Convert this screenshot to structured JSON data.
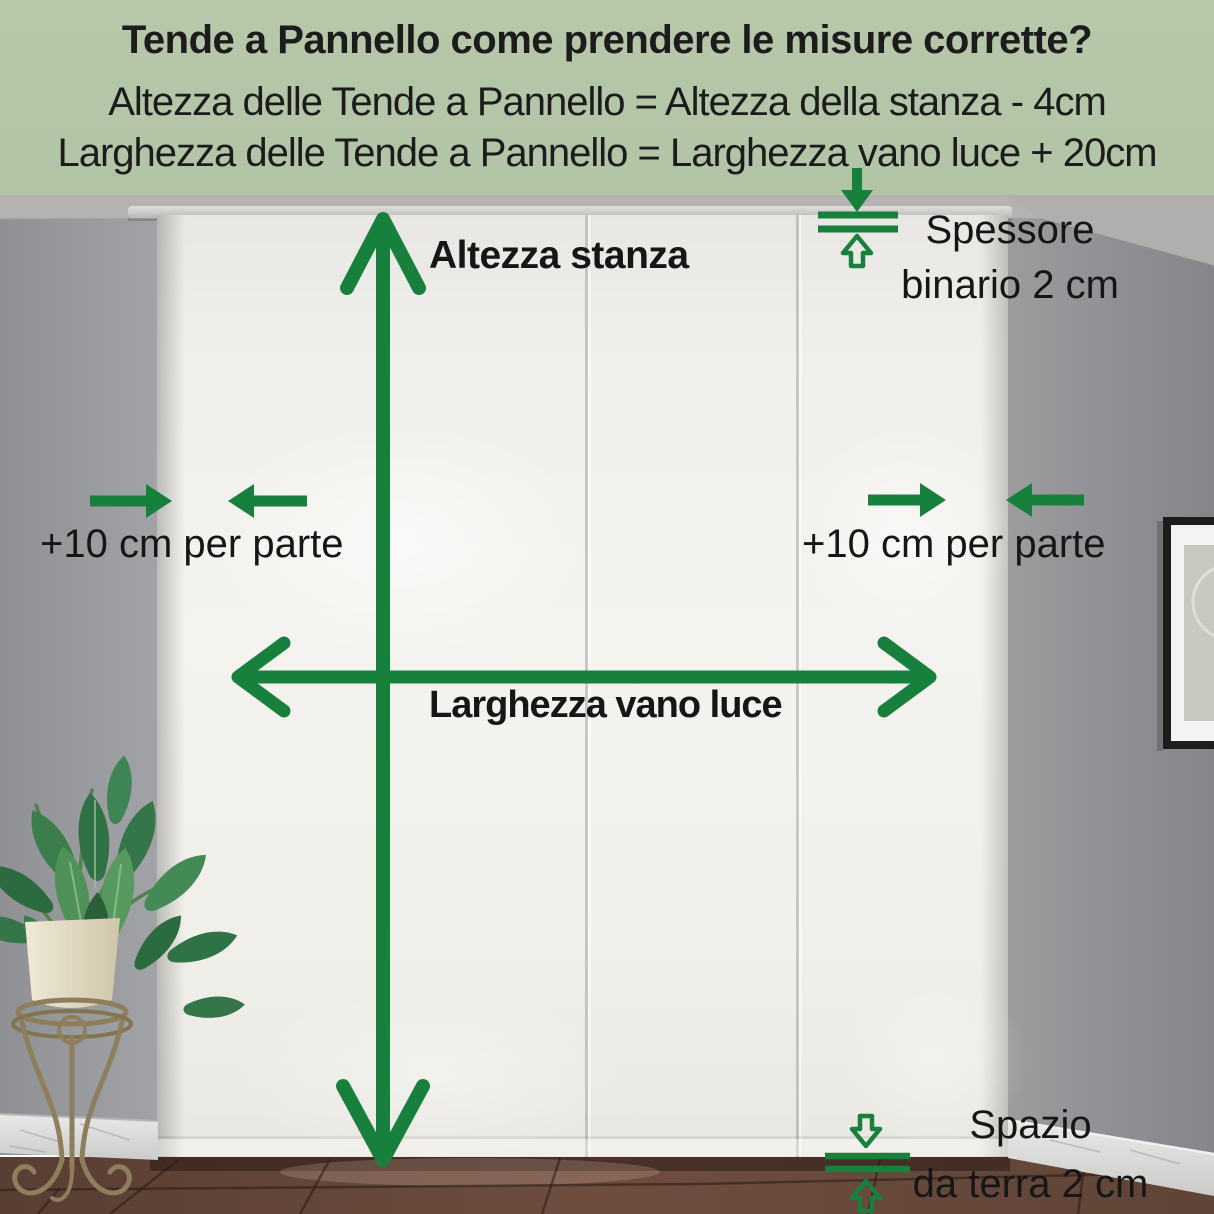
{
  "header": {
    "title": "Tende a Pannello come prendere le misure corrette?",
    "formula_height": "Altezza delle Tende a Pannello = Altezza della stanza - 4cm",
    "formula_width": "Larghezza delle Tende a Pannello = Larghezza vano luce + 20cm",
    "background_color": "#b6c8a9",
    "text_color": "#1c1c1c"
  },
  "annotations": {
    "accent_color": "#17803c",
    "room_height": "Altezza stanza",
    "opening_width": "Larghezza vano luce",
    "side_allowance_left": "+10 cm per parte",
    "side_allowance_right": "+10 cm per parte",
    "track_thickness_line1": "Spessore",
    "track_thickness_line2": "binario 2 cm",
    "floor_gap_line1": "Spazio",
    "floor_gap_line2": "da terra 2 cm"
  }
}
